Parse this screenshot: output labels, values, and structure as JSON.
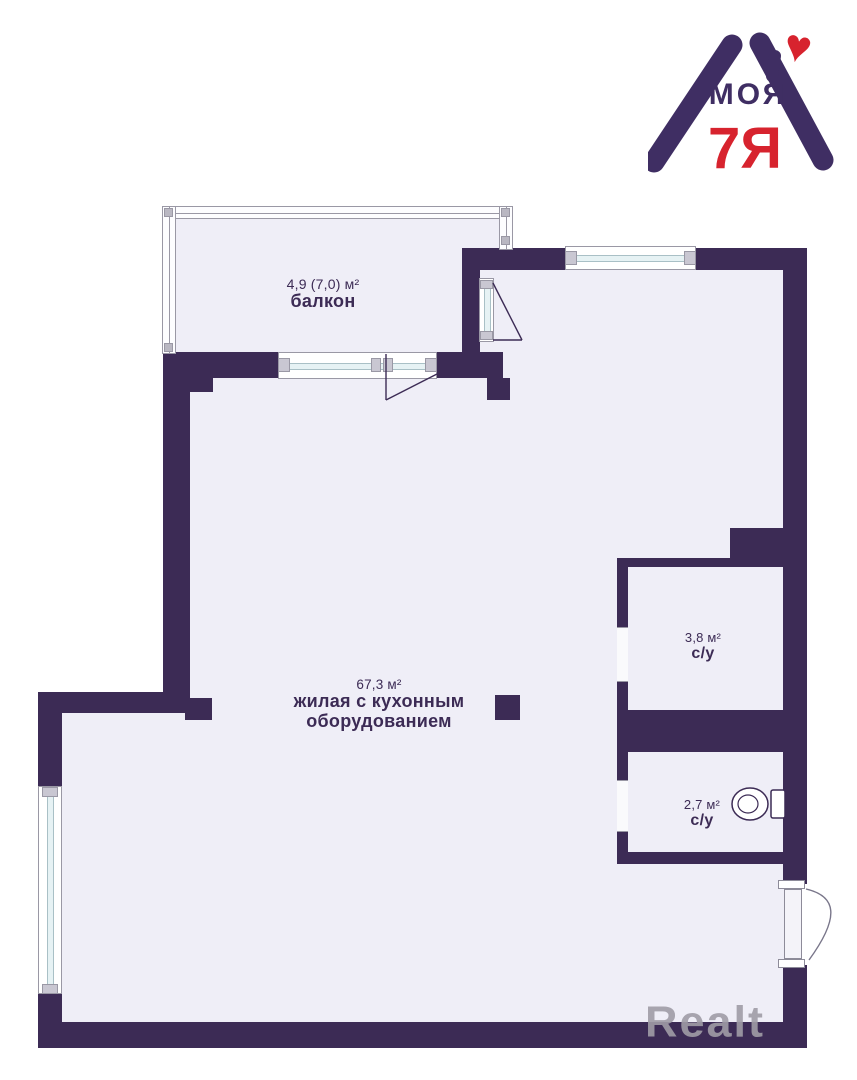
{
  "colors": {
    "wall": "#3C2B55",
    "floor": "#EFEEF7",
    "logo_purple": "#3F2E63",
    "logo_red": "#D7232E",
    "glass": "#E6F2F4",
    "frame": "#9A98A5",
    "watermark": "#A09DA7",
    "background": "#FFFFFF"
  },
  "logo": {
    "brand_top": "МОЯ",
    "brand_bottom": "7Я",
    "heart_icon": "♥"
  },
  "watermark": {
    "text": "Realt"
  },
  "plan": {
    "rooms": [
      {
        "key": "balcony",
        "area": "4,9 (7,0) м²",
        "name": "балкон"
      },
      {
        "key": "living-kitchen",
        "area": "67,3 м²",
        "name": "жилая с кухонным оборудованием"
      },
      {
        "key": "bathroom-top",
        "area": "3,8 м²",
        "name": "с/у"
      },
      {
        "key": "bathroom-bottom",
        "area": "2,7 м²",
        "name": "с/у"
      }
    ]
  }
}
